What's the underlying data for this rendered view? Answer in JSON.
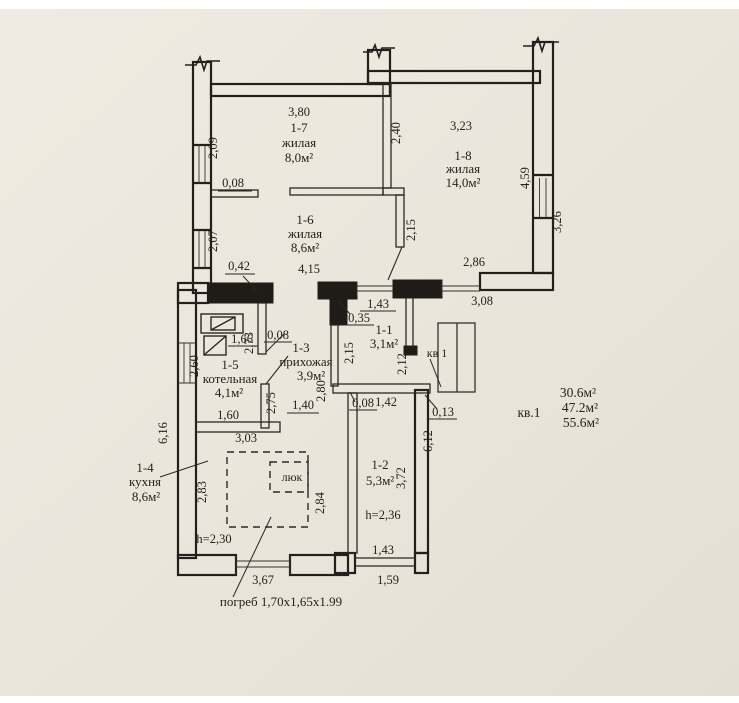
{
  "apartment": {
    "label": "кв.1",
    "door_label": "кв 1",
    "areas": [
      "30.6м²",
      "47.2м²",
      "55.6м²"
    ],
    "cellar_note": "погреб 1,70х1,65х1.99",
    "hatch_label": "люк"
  },
  "rooms": {
    "r17": {
      "num": "1-7",
      "name": "жилая",
      "area": "8,0м²"
    },
    "r16": {
      "num": "1-6",
      "name": "жилая",
      "area": "8,6м²"
    },
    "r18": {
      "num": "1-8",
      "name": "жилая",
      "area": "14,0м²"
    },
    "r15": {
      "num": "1-5",
      "name": "котельная",
      "area": "4,1м²"
    },
    "r13": {
      "num": "1-3",
      "name": "прихожая",
      "area": "3,9м²"
    },
    "r11": {
      "num": "1-1",
      "area": "3,1м²"
    },
    "r14": {
      "num": "1-4",
      "name": "кухня",
      "area": "8,6м²",
      "height": "h=2,30"
    },
    "r12": {
      "num": "1-2",
      "area": "5,3м²",
      "height": "h=2,36"
    }
  },
  "dims": {
    "top_w_17": "3,80",
    "left_209": "2,09",
    "part_008a": "0,08",
    "left_207": "2,07",
    "mid_240": "2,40",
    "top_w_18": "3,23",
    "right_459": "4,59",
    "right_326": "3,26",
    "part_215a": "2,15",
    "wall_042": "0,42",
    "hall_415": "4,15",
    "hall_286": "2,86",
    "hall_308": "3,08",
    "r11_143": "1,43",
    "r11_035": "0,35",
    "r11_215": "2,15",
    "r11_212": "2,12",
    "boiler_166": "1,66",
    "part_008b": "0,08",
    "left_260": "2,60",
    "part_273": "2,73",
    "part_275": "2,75",
    "r15_160": "1,60",
    "door_140": "1,40",
    "hall_280": "2,80",
    "wall_303": "3,03",
    "left_616": "6,16",
    "r12_008": "0,08",
    "r12_142": "1,42",
    "r12_013": "0,13",
    "r12_612": "6,12",
    "r14_283": "2,83",
    "r14_284": "2,84",
    "r12_372": "3,72",
    "bottom_367": "3,67",
    "r12_143": "1,43",
    "r12_159": "1,59"
  },
  "colors": {
    "paper": "#eae6dc",
    "ink": "#262219"
  }
}
